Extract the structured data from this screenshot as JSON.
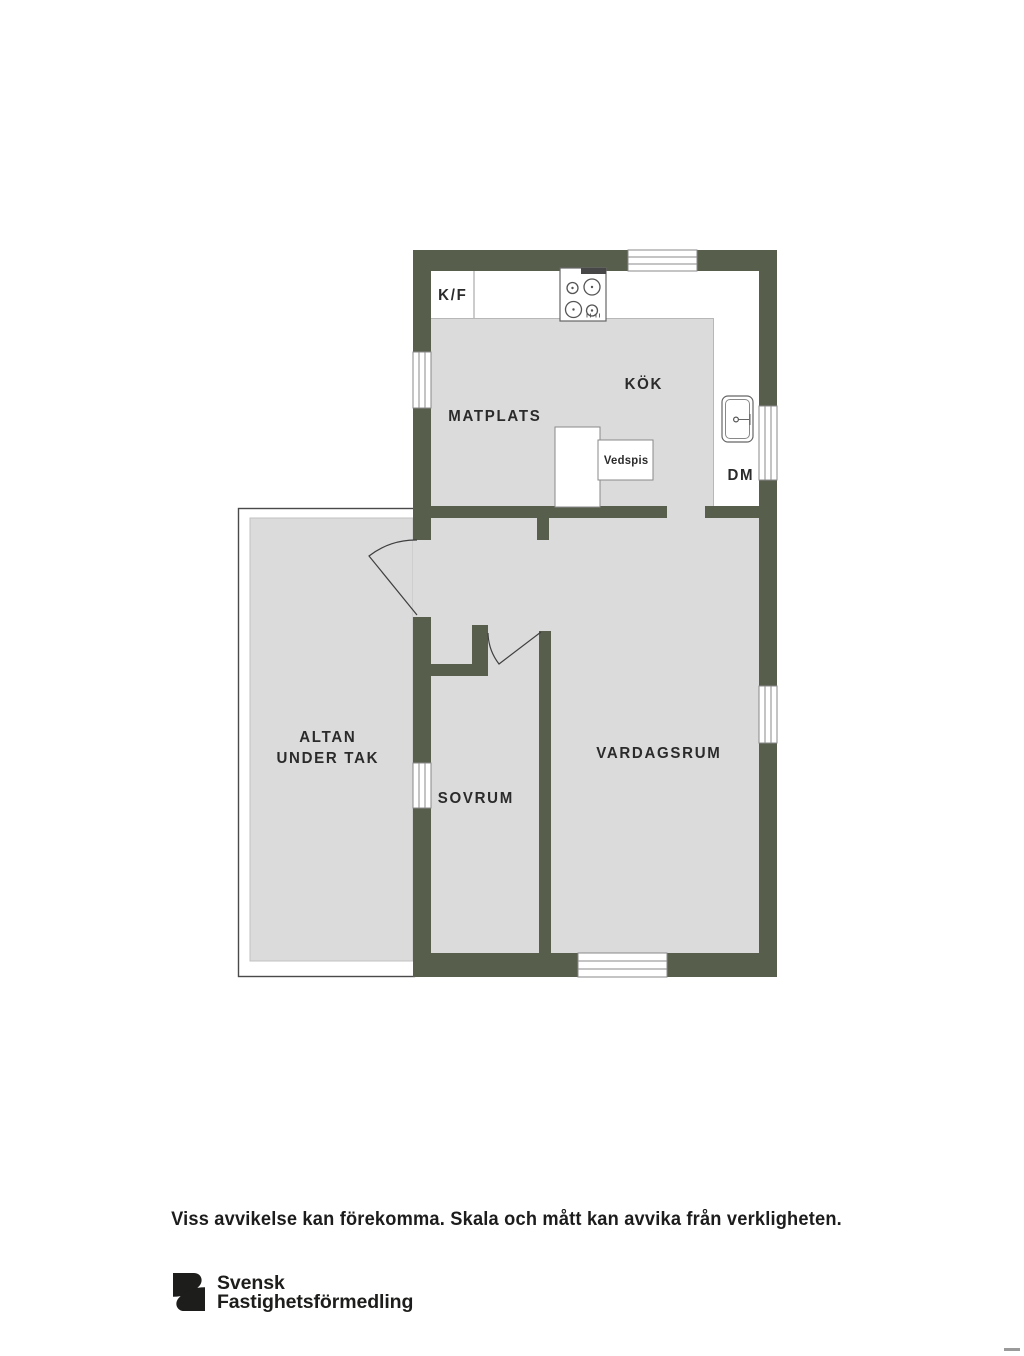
{
  "floorplan": {
    "labels": {
      "kf": "K/F",
      "kok": "KÖK",
      "matplats": "MATPLATS",
      "vedspis": "Vedspis",
      "dm": "DM",
      "altan_line1": "ALTAN",
      "altan_line2": "UNDER TAK",
      "sovrum": "SOVRUM",
      "vardagsrum": "VARDAGSRUM"
    },
    "colors": {
      "wall": "#585E4C",
      "floor": "#DBDBDB"
    }
  },
  "footer": {
    "disclaimer": "Viss avvikelse kan förekomma. Skala och mått kan avvika från verkligheten."
  },
  "logo": {
    "line1": "Svensk",
    "line2": "Fastighetsförmedling"
  }
}
